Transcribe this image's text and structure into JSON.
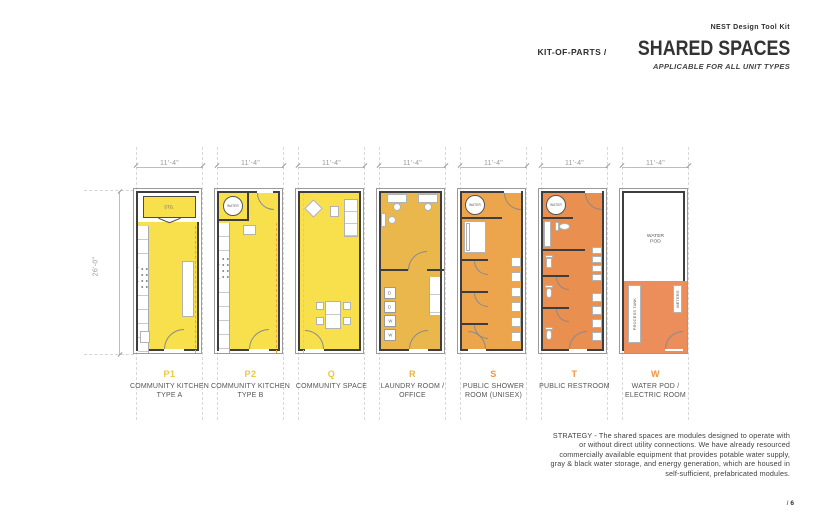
{
  "header": {
    "toolkit_label": "NEST Design Tool Kit",
    "kicker": "KIT-OF-PARTS /",
    "title": "SHARED SPACES",
    "subtitle": "APPLICABLE FOR ALL UNIT TYPES"
  },
  "dimensions": {
    "module_width": "11'-4\"",
    "module_height": "26'-0\""
  },
  "plan_labels": {
    "storage": "STG.",
    "water": "WATER",
    "dryer": "D",
    "washer": "W",
    "water_pod": "WATER POD",
    "process_tank": "PROCESS TANK",
    "meters": "METERS"
  },
  "modules": [
    {
      "id": "P1",
      "name": "COMMUNITY KITCHEN TYPE A",
      "accent": "#efc838",
      "fill": "#f7e04c"
    },
    {
      "id": "P2",
      "name": "COMMUNITY KITCHEN TYPE B",
      "accent": "#efc838",
      "fill": "#f7e04c"
    },
    {
      "id": "Q",
      "name": "COMMUNITY SPACE",
      "accent": "#efc838",
      "fill": "#f7e04c"
    },
    {
      "id": "R",
      "name": "LAUNDRY ROOM / OFFICE",
      "accent": "#e8b23f",
      "fill": "#e9b74b"
    },
    {
      "id": "S",
      "name": "PUBLIC SHOWER ROOM (UNISEX)",
      "accent": "#f2953f",
      "fill": "#eda54d"
    },
    {
      "id": "T",
      "name": "PUBLIC RESTROOM",
      "accent": "#f2953f",
      "fill": "#e98f50"
    },
    {
      "id": "W",
      "name": "WATER POD / ELECTRIC ROOM",
      "accent": "#f2953f",
      "fill": "#ec8d5c"
    }
  ],
  "strategy_text": "STRATEGY - The shared spaces are modules designed to operate with or without direct utility connections. We have already resourced commercially available equipment that provides potable water supply, gray & black water storage, and energy generation, which are housed in self-sufficient, prefabricated modules.",
  "page": {
    "slash": "/",
    "num": "6"
  }
}
